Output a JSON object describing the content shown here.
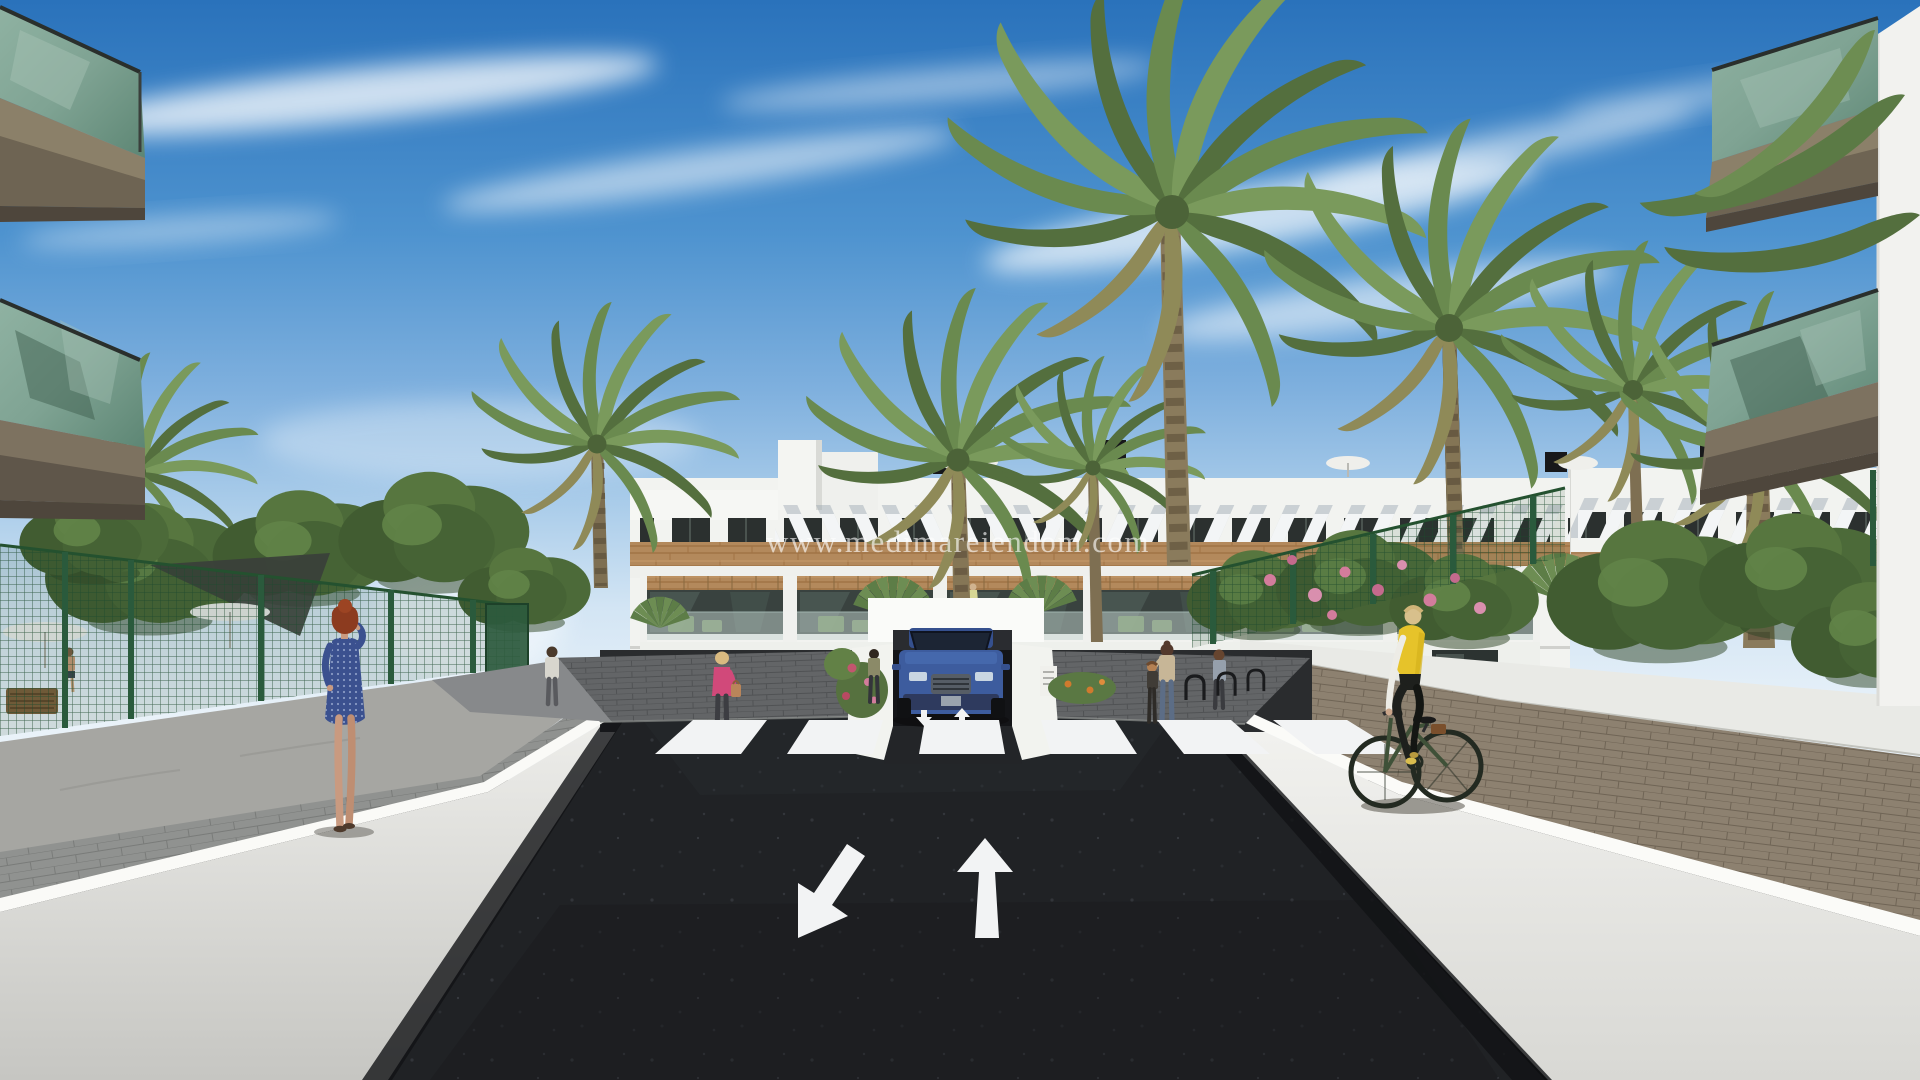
{
  "watermark": {
    "text": "www.medimareiendom.com"
  },
  "palette": {
    "sky_top": "#2a72bb",
    "sky_horizon": "#e9f2f9",
    "cloud_white": "#ffffff",
    "building_white": "#f2f3f0",
    "wood_cladding": "#b3895c",
    "awning_stripe_grey": "#9aa6b1",
    "window_dark": "#2b302f",
    "balcony_glass_green": "#7fa393",
    "balcony_slab_taupe": "#8b8069",
    "palm_green": "#6a8a4f",
    "bush_green": "#4e6c3a",
    "fence_green": "#1e4a2e",
    "asphalt_dark": "#202225",
    "road_marking_white": "#f2f3f4",
    "retaining_wall_white": "#f0f0ed",
    "paver_grey": "#909290",
    "paver_brown": "#8d8170",
    "car_blue": "#3d5c9e",
    "vest_yellow": "#e6c32a",
    "dress_blue": "#3b518f",
    "hair_red": "#8e3d20",
    "flower_pink": "#d37c9c",
    "flower_orange": "#cf7a2e"
  },
  "scene": {
    "type": "architectural-exterior-render",
    "setting": "modern three-storey white apartment complex with wood cladding, palm trees and a sunken access road to an underground garage",
    "road_markings": {
      "crosswalk_stripes": 6,
      "lane_arrows": [
        "down-left",
        "up"
      ],
      "small_ramp_arrows": [
        "down",
        "up"
      ]
    },
    "vehicles": [
      {
        "name": "blue-suv",
        "detail": "dark blue SUV at the garage ramp entrance, center"
      }
    ],
    "people": [
      {
        "name": "woman-blue-dress",
        "detail": "red-haired woman in blue dress on the phone, left walkway"
      },
      {
        "name": "cyclist-yellow-vest",
        "detail": "blonde cyclist in yellow vest on right walkway"
      },
      {
        "name": "woman-pink-top",
        "detail": "blonde woman in pink top with handbag near left apron"
      },
      {
        "name": "man-grey-shirt",
        "detail": "man walking near the garden gate"
      },
      {
        "name": "person-at-garage",
        "detail": "person standing beside the garage wall"
      },
      {
        "name": "woman-with-child",
        "detail": "woman and child standing on right apron"
      },
      {
        "name": "woman-grey-top",
        "detail": "woman standing near the bike racks"
      },
      {
        "name": "man-in-garden",
        "detail": "shirtless man behind the left fence"
      }
    ],
    "landscape": [
      "phoenix-palm-trees",
      "fan-palms",
      "leafy-trees",
      "pink-flower-bushes",
      "orange-flower-bed",
      "rose-bushes"
    ],
    "structures": [
      "apartment-building",
      "striped-awning-band",
      "wood-cladding-band",
      "balcony-row",
      "ground-floor-terraces",
      "underground-garage-entrance",
      "foreground-balconies-left",
      "foreground-balconies-right",
      "green-mesh-fences",
      "white-retaining-walls",
      "zebra-crosswalk"
    ]
  }
}
